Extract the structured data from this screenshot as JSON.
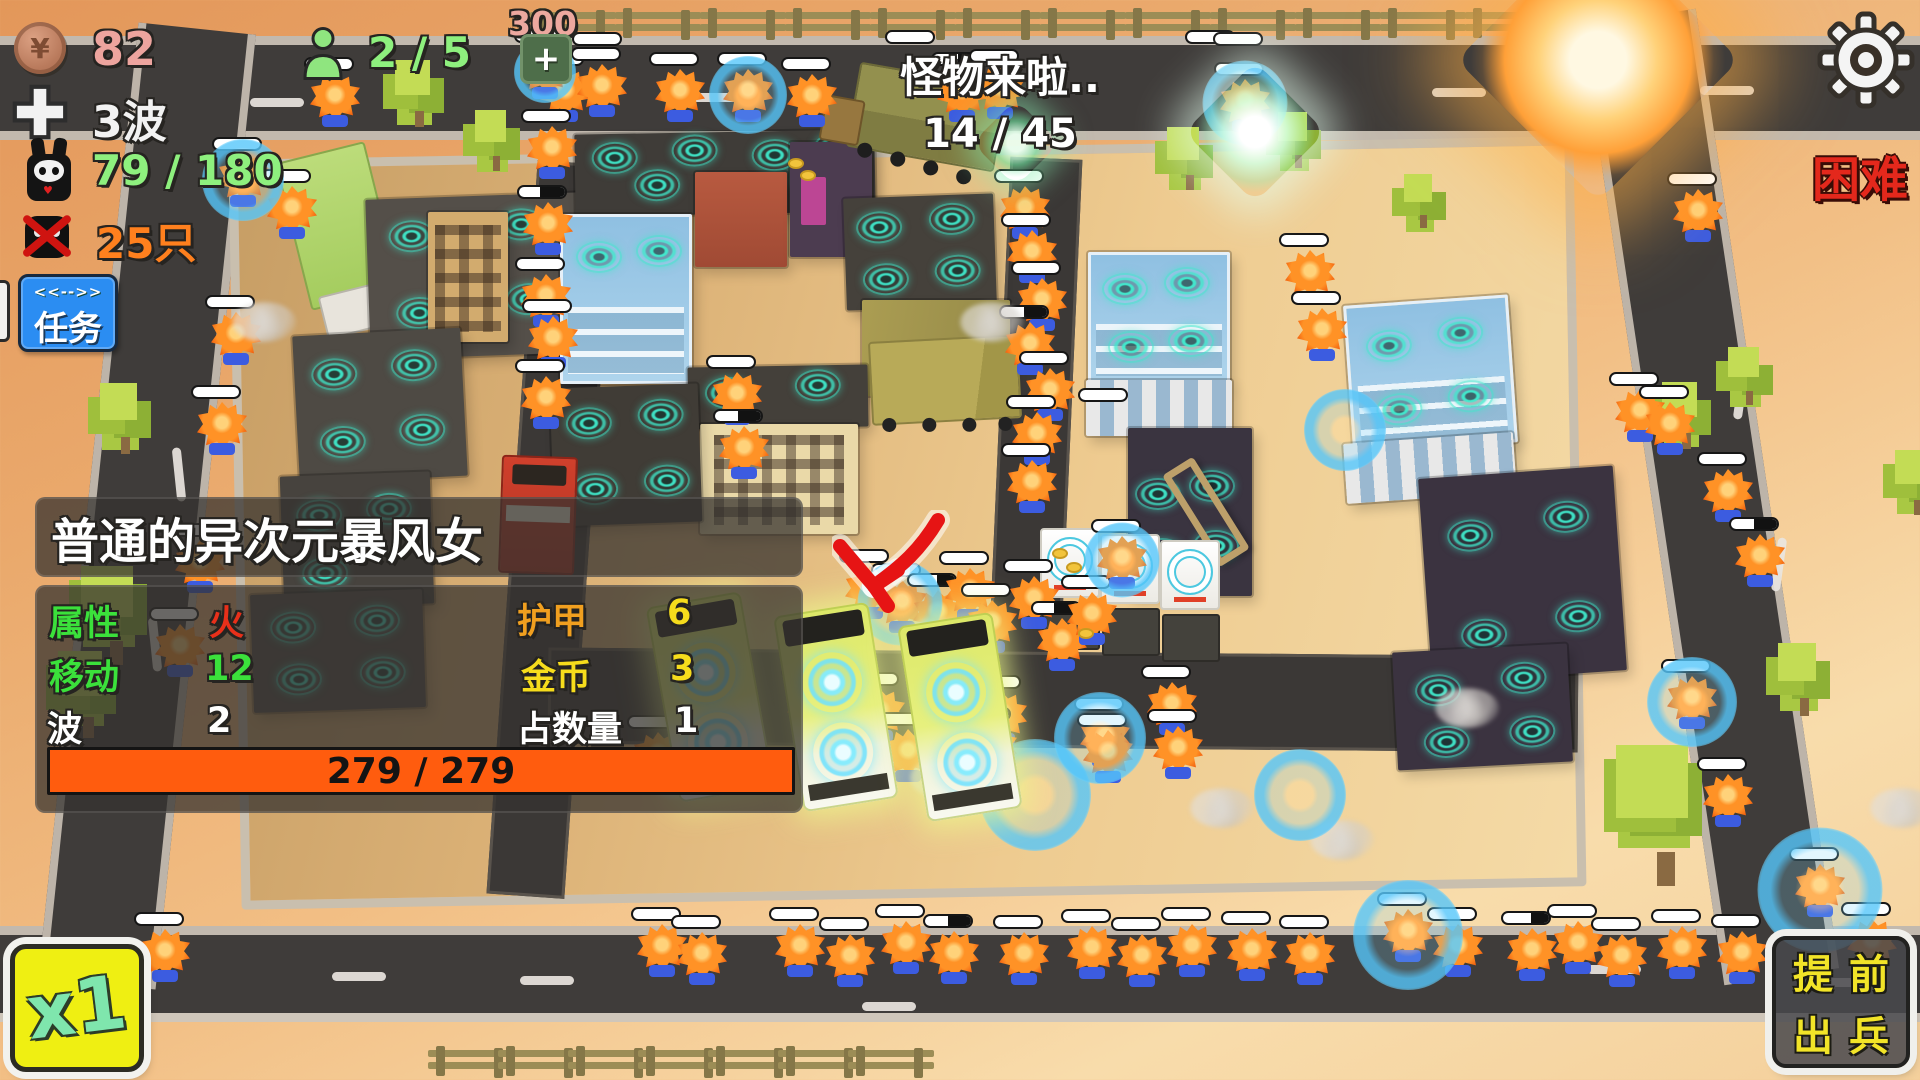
{
  "hud": {
    "coins": "82",
    "coin_symbol": "¥",
    "wave": "3波",
    "kills": "79 / 180",
    "monsters_left": "25只",
    "population": "2 / 5",
    "add_cost": "300",
    "add_label": "+",
    "announce_line1": "怪物来啦..",
    "announce_line2": "14 / 45",
    "difficulty": "困难",
    "task_button": {
      "top": "<<-->>",
      "label": "任务"
    },
    "speed_button": "x1",
    "deploy_button": {
      "line1": "提前",
      "line2": "出兵"
    }
  },
  "info_panel": {
    "title": "普通的异次元暴风女",
    "rows": [
      {
        "label": "属性",
        "value": "火"
      },
      {
        "label": "移动",
        "value": "12"
      },
      {
        "label": "波",
        "value": "2"
      },
      {
        "label": "护甲",
        "value": "6"
      },
      {
        "label": "金币",
        "value": "3"
      },
      {
        "label": "占数量",
        "value": "1"
      }
    ],
    "hp": "279 / 279"
  },
  "icons": [
    "coin-icon",
    "plus-icon",
    "rabbit-skull-icon",
    "no-monster-icon",
    "person-icon",
    "gear-icon",
    "turret-icon",
    "shield-bubble",
    "red-arrow-marker"
  ],
  "colors": {
    "hud_pink": "#eda49e",
    "hud_green": "#8ef07e",
    "hud_orange": "#ff801e",
    "difficulty_red": "#e4281c",
    "task_blue": "#2b8df2",
    "panel_bg": "rgba(52,50,47,.74)",
    "hp_orange": "#ff5c0e",
    "speed_yellow": "#efef12",
    "deploy_yellow": "#f2e428",
    "turret_teal": "#3ee8ca",
    "shield_blue": "#55c6fa",
    "monster_orange": "#ff9226",
    "road": "#3f3c3a",
    "ground_peach": "#eaa96c"
  },
  "scene": {
    "fences_top": [
      530,
      615,
      700,
      785,
      870,
      955,
      1040,
      1125,
      1210,
      1295,
      1380,
      1465,
      1550
    ],
    "fences_bottom": [
      428,
      498,
      568,
      638,
      708,
      778,
      848
    ],
    "dashes": [
      [
        250,
        98,
        0
      ],
      [
        690,
        93,
        0
      ],
      [
        1432,
        88,
        0
      ],
      [
        1700,
        86,
        0
      ],
      [
        332,
        972,
        0
      ],
      [
        520,
        976,
        0
      ],
      [
        862,
        1002,
        0
      ],
      [
        1587,
        965,
        0
      ],
      [
        1822,
        978,
        0
      ],
      [
        152,
        470,
        84
      ],
      [
        128,
        640,
        84
      ],
      [
        1714,
        388,
        -82
      ],
      [
        1752,
        560,
        -82
      ]
    ],
    "trees": [
      [
        92,
        380,
        66
      ],
      [
        70,
        562,
        92
      ],
      [
        48,
        648,
        80
      ],
      [
        388,
        58,
        62
      ],
      [
        468,
        108,
        56
      ],
      [
        1160,
        125,
        58
      ],
      [
        1272,
        110,
        52
      ],
      [
        1398,
        172,
        50
      ],
      [
        1655,
        380,
        62
      ],
      [
        1722,
        345,
        54
      ],
      [
        1600,
        740,
        130
      ],
      [
        1770,
        640,
        68
      ],
      [
        1888,
        448,
        60
      ]
    ],
    "buildings": [
      {
        "x": 368,
        "y": 196,
        "w": 215,
        "h": 160,
        "c": "#544f49",
        "r": -2,
        "t": [
          [
            45,
            38
          ],
          [
            155,
            30
          ],
          [
            50,
            115
          ],
          [
            160,
            105
          ]
        ]
      },
      {
        "x": 428,
        "y": 212,
        "w": 80,
        "h": 130,
        "k": "tan windows"
      },
      {
        "x": 296,
        "y": 332,
        "w": 168,
        "h": 148,
        "c": "#4e4a44",
        "r": -3,
        "t": [
          [
            40,
            40
          ],
          [
            120,
            35
          ],
          [
            45,
            108
          ],
          [
            125,
            100
          ]
        ]
      },
      {
        "x": 282,
        "y": 474,
        "w": 150,
        "h": 132,
        "c": "#47433e",
        "r": -2,
        "t": [
          [
            38,
            40
          ],
          [
            108,
            36
          ],
          [
            42,
            98
          ]
        ]
      },
      {
        "x": 252,
        "y": 592,
        "w": 172,
        "h": 118,
        "c": "#514c46",
        "r": -2,
        "t": [
          [
            42,
            34
          ],
          [
            126,
            30
          ],
          [
            46,
            86
          ],
          [
            130,
            82
          ]
        ]
      },
      {
        "x": 575,
        "y": 132,
        "w": 300,
        "h": 82,
        "c": "#3f3c38",
        "r": -1,
        "t": [
          [
            40,
            24
          ],
          [
            120,
            18
          ],
          [
            200,
            24
          ],
          [
            262,
            18
          ],
          [
            82,
            52
          ],
          [
            240,
            50
          ]
        ]
      },
      {
        "x": 560,
        "y": 214,
        "w": 132,
        "h": 170,
        "k": "glass",
        "t": [
          [
            36,
            40
          ],
          [
            96,
            34
          ]
        ]
      },
      {
        "x": 695,
        "y": 172,
        "w": 92,
        "h": 95,
        "k": "red"
      },
      {
        "x": 790,
        "y": 142,
        "w": 82,
        "h": 115,
        "k": "purple"
      },
      {
        "x": 845,
        "y": 196,
        "w": 150,
        "h": 112,
        "c": "#45413b",
        "r": -2,
        "t": [
          [
            35,
            30
          ],
          [
            108,
            24
          ],
          [
            40,
            82
          ],
          [
            112,
            76
          ]
        ]
      },
      {
        "x": 862,
        "y": 300,
        "w": 148,
        "h": 96,
        "k": "gold"
      },
      {
        "x": 688,
        "y": 366,
        "w": 180,
        "h": 62,
        "c": "#44403a",
        "r": -1,
        "t": [
          [
            40,
            26
          ],
          [
            130,
            20
          ]
        ]
      },
      {
        "x": 700,
        "y": 424,
        "w": 158,
        "h": 110,
        "k": "cream windows"
      },
      {
        "x": 552,
        "y": 386,
        "w": 148,
        "h": 138,
        "c": "#403c36",
        "r": -2,
        "t": [
          [
            38,
            36
          ],
          [
            110,
            30
          ],
          [
            42,
            102
          ],
          [
            114,
            96
          ]
        ]
      },
      {
        "x": 1088,
        "y": 252,
        "w": 142,
        "h": 132,
        "k": "glass",
        "t": [
          [
            34,
            34
          ],
          [
            96,
            28
          ],
          [
            40,
            92
          ],
          [
            100,
            86
          ]
        ]
      },
      {
        "x": 1086,
        "y": 380,
        "w": 146,
        "h": 56,
        "k": "stripes"
      },
      {
        "x": 1128,
        "y": 428,
        "w": 124,
        "h": 168,
        "c": "#3a3440",
        "t": [
          [
            30,
            66
          ],
          [
            84,
            58
          ],
          [
            34,
            126
          ],
          [
            88,
            118
          ]
        ]
      },
      {
        "x": 1348,
        "y": 300,
        "w": 165,
        "h": 148,
        "k": "glass",
        "r": -4,
        "t": [
          [
            40,
            40
          ],
          [
            112,
            32
          ],
          [
            46,
            104
          ],
          [
            118,
            96
          ]
        ]
      },
      {
        "x": 1345,
        "y": 438,
        "w": 170,
        "h": 60,
        "k": "stripes",
        "r": -4
      },
      {
        "x": 1425,
        "y": 472,
        "w": 195,
        "h": 205,
        "c": "#3b3340",
        "r": -4,
        "t": [
          [
            48,
            60
          ],
          [
            145,
            48
          ],
          [
            55,
            160
          ],
          [
            150,
            148
          ]
        ]
      },
      {
        "x": 1395,
        "y": 648,
        "w": 175,
        "h": 118,
        "c": "#3b3340",
        "r": -3,
        "t": [
          [
            44,
            40
          ],
          [
            130,
            32
          ],
          [
            50,
            92
          ],
          [
            136,
            86
          ]
        ]
      }
    ],
    "appliances": [
      [
        1040,
        528
      ],
      [
        1100,
        534
      ],
      [
        1160,
        540
      ]
    ],
    "buses": [
      [
        662,
        598,
        -10
      ],
      [
        788,
        608,
        -9
      ],
      [
        912,
        618,
        -9
      ]
    ],
    "monsters": [
      [
        335,
        100
      ],
      [
        565,
        95
      ],
      [
        602,
        90
      ],
      [
        680,
        95
      ],
      [
        748,
        95
      ],
      [
        812,
        100
      ],
      [
        962,
        95,
        0.55
      ],
      [
        1000,
        92
      ],
      [
        1245,
        105
      ],
      [
        1545,
        95
      ],
      [
        1582,
        100,
        0.6
      ],
      [
        243,
        180
      ],
      [
        292,
        212
      ],
      [
        236,
        338
      ],
      [
        222,
        428
      ],
      [
        200,
        566
      ],
      [
        180,
        650
      ],
      [
        545,
        72
      ],
      [
        552,
        152
      ],
      [
        548,
        228,
        0.45
      ],
      [
        546,
        300
      ],
      [
        553,
        342
      ],
      [
        546,
        402
      ],
      [
        737,
        398
      ],
      [
        744,
        452,
        0.5
      ],
      [
        1025,
        212
      ],
      [
        1032,
        256
      ],
      [
        1042,
        304
      ],
      [
        1030,
        348,
        0.5
      ],
      [
        1050,
        394
      ],
      [
        1037,
        438
      ],
      [
        1032,
        486
      ],
      [
        1310,
        276
      ],
      [
        1322,
        334
      ],
      [
        870,
        592
      ],
      [
        902,
        606
      ],
      [
        938,
        616,
        0.6
      ],
      [
        970,
        594
      ],
      [
        992,
        626
      ],
      [
        1034,
        602
      ],
      [
        1062,
        644,
        0.45
      ],
      [
        1092,
        618
      ],
      [
        1122,
        562
      ],
      [
        1698,
        215
      ],
      [
        1640,
        415
      ],
      [
        1670,
        428
      ],
      [
        1728,
        495
      ],
      [
        1760,
        560,
        0.5
      ],
      [
        1692,
        702
      ],
      [
        1728,
        800
      ],
      [
        1820,
        890
      ],
      [
        1872,
        945
      ],
      [
        812,
        708,
        0.55
      ],
      [
        880,
        715
      ],
      [
        1002,
        718
      ],
      [
        1105,
        740
      ],
      [
        1172,
        708
      ],
      [
        658,
        758
      ],
      [
        908,
        755
      ],
      [
        992,
        750,
        0.5
      ],
      [
        1108,
        756
      ],
      [
        1178,
        752
      ],
      [
        165,
        955
      ],
      [
        662,
        950
      ],
      [
        702,
        958
      ],
      [
        800,
        950
      ],
      [
        850,
        960
      ],
      [
        906,
        947
      ],
      [
        954,
        957,
        0.5
      ],
      [
        1024,
        958
      ],
      [
        1092,
        952
      ],
      [
        1142,
        960
      ],
      [
        1192,
        950
      ],
      [
        1252,
        954
      ],
      [
        1310,
        958
      ],
      [
        1408,
        935
      ],
      [
        1458,
        950
      ],
      [
        1532,
        954,
        0.6
      ],
      [
        1578,
        947
      ],
      [
        1622,
        960
      ],
      [
        1682,
        952
      ],
      [
        1742,
        957
      ]
    ],
    "pills_solo": [
      [
        572,
        32
      ],
      [
        885,
        30
      ],
      [
        1185,
        30
      ],
      [
        1213,
        32
      ],
      [
        1078,
        388
      ]
    ],
    "shields": [
      [
        545,
        72,
        62
      ],
      [
        748,
        95,
        78
      ],
      [
        1245,
        103,
        85
      ],
      [
        243,
        180,
        82
      ],
      [
        900,
        603,
        85
      ],
      [
        1122,
        560,
        75
      ],
      [
        1345,
        430,
        82
      ],
      [
        1692,
        702,
        90
      ],
      [
        1820,
        890,
        125
      ],
      [
        1035,
        795,
        112
      ],
      [
        1408,
        935,
        110
      ],
      [
        1300,
        795,
        92
      ],
      [
        1100,
        738,
        92
      ]
    ],
    "smoke": [
      [
        645,
        758
      ],
      [
        910,
        758
      ],
      [
        1190,
        788
      ],
      [
        232,
        302
      ],
      [
        960,
        302
      ],
      [
        1435,
        688
      ],
      [
        1870,
        788
      ],
      [
        905,
        618
      ],
      [
        1310,
        820
      ]
    ],
    "coins_drop": [
      [
        788,
        158
      ],
      [
        800,
        170
      ],
      [
        1052,
        548
      ],
      [
        1066,
        562
      ],
      [
        1078,
        628
      ]
    ],
    "glows": [
      {
        "x": 1498,
        "y": -40,
        "s": 200,
        "k": "orange"
      },
      {
        "x": 1205,
        "y": 82,
        "s": 100,
        "k": "white"
      },
      {
        "x": 985,
        "y": 112,
        "s": 62,
        "k": "green"
      }
    ]
  }
}
